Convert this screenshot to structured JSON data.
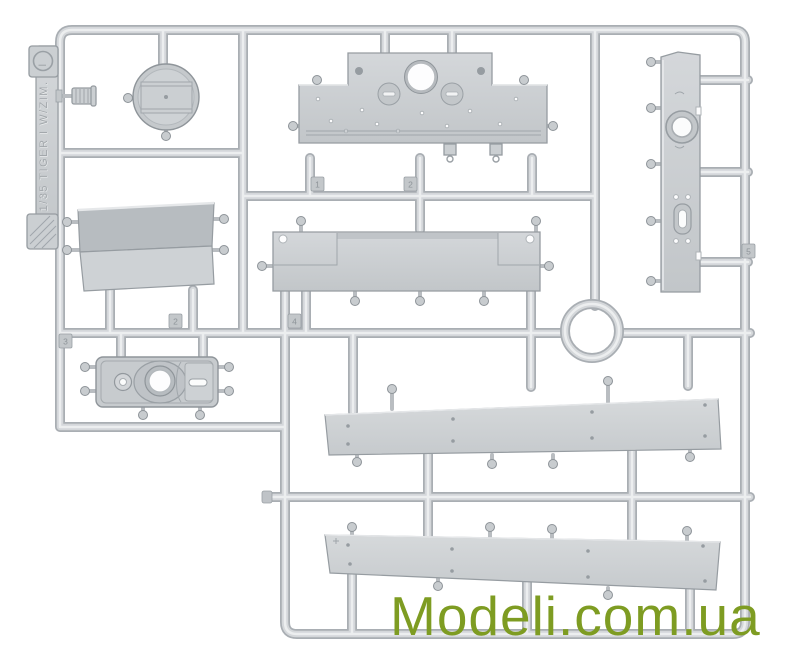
{
  "meta": {
    "background_color": "#ffffff",
    "description": "Photo of a light-gray injection-molded plastic model kit sprue (parts tree) on white background",
    "plastic_color": "#c9cdd1"
  },
  "watermark": {
    "text": "Modeli.com.ua",
    "color": "#7e9c22"
  },
  "sprue": {
    "tab": {
      "label": "1/35 TIGER I W/ZIM.",
      "sprue_letter": "I"
    },
    "number_tags": [
      {
        "label": "1"
      },
      {
        "label": "2"
      },
      {
        "label": "2"
      },
      {
        "label": "4"
      },
      {
        "label": "3"
      },
      {
        "label": "5"
      }
    ],
    "parts": [
      {
        "name": "round-hatch"
      },
      {
        "name": "engine-deck-panel"
      },
      {
        "name": "rear-hull-plate"
      },
      {
        "name": "glacis-panel"
      },
      {
        "name": "hull-floor-panel"
      },
      {
        "name": "transmission-cover"
      },
      {
        "name": "upper-fender"
      },
      {
        "name": "lower-fender"
      },
      {
        "name": "knurled-knob"
      },
      {
        "name": "runner-ring"
      }
    ]
  }
}
